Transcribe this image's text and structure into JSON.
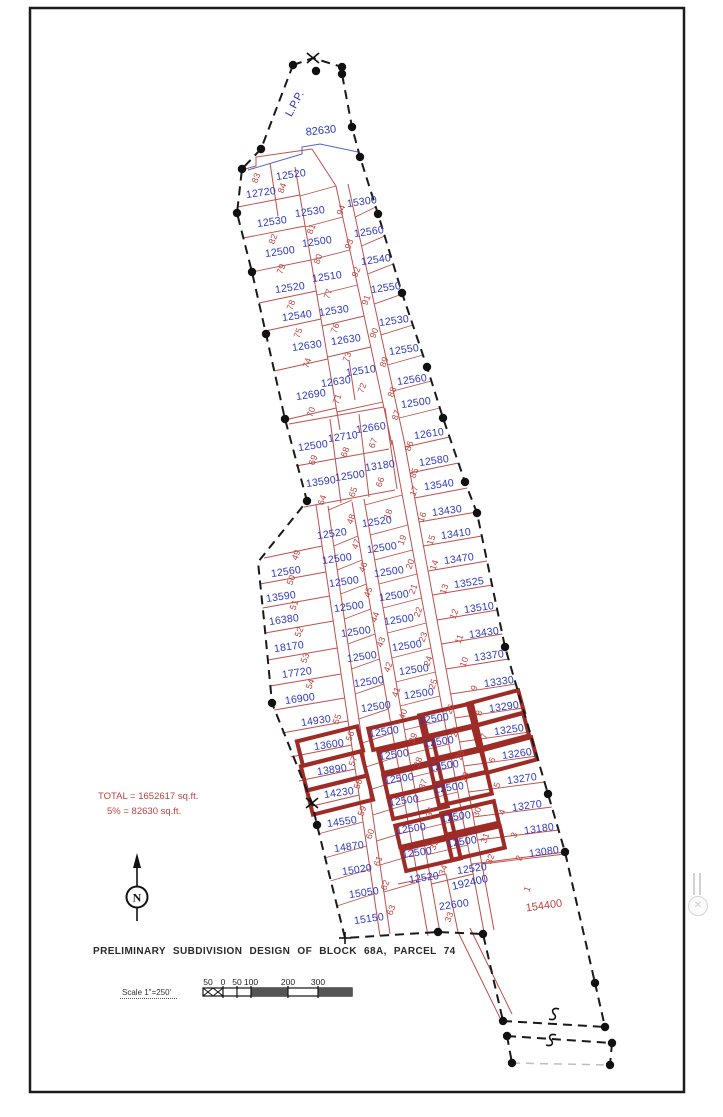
{
  "drawing": {
    "title": "PRELIMINARY SUBDIVISION DESIGN OF BLOCK 68A, PARCEL 74",
    "scale": {
      "label": "Scale 1\"=250'",
      "ticks": [
        "50",
        "0",
        "50",
        "100",
        "200",
        "300"
      ]
    },
    "summary": {
      "line1": "TOTAL  =  1652617  sq.ft.",
      "line2": "5%  =  82630  sq.ft."
    },
    "north_label": "N",
    "colors": {
      "area_text": "#2b36c4",
      "lot_text": "#bf4440",
      "lot_line": "#c0504d",
      "highlight": "#9e2b25",
      "boundary": "#1a1a1a"
    },
    "annotations": [
      {
        "t": "82630",
        "x": 321,
        "y": 131,
        "r": -6,
        "c": "blue ann"
      },
      {
        "t": "L.P.P.",
        "x": 295,
        "y": 104,
        "r": -62,
        "c": "blue ann"
      },
      {
        "t": "192400",
        "x": 470,
        "y": 883,
        "r": -13,
        "c": "blue ann"
      }
    ],
    "area_labels": [
      {
        "t": "12720",
        "x": 261,
        "y": 193
      },
      {
        "t": "12520",
        "x": 291,
        "y": 175
      },
      {
        "t": "12530",
        "x": 272,
        "y": 222
      },
      {
        "t": "12500",
        "x": 280,
        "y": 252
      },
      {
        "t": "12520",
        "x": 290,
        "y": 288
      },
      {
        "t": "12540",
        "x": 297,
        "y": 316
      },
      {
        "t": "12630",
        "x": 307,
        "y": 346
      },
      {
        "t": "12690",
        "x": 311,
        "y": 395
      },
      {
        "t": "12530",
        "x": 310,
        "y": 212
      },
      {
        "t": "12500",
        "x": 317,
        "y": 242
      },
      {
        "t": "12510",
        "x": 327,
        "y": 277
      },
      {
        "t": "12530",
        "x": 334,
        "y": 311
      },
      {
        "t": "12630",
        "x": 346,
        "y": 340
      },
      {
        "t": "12630",
        "x": 336,
        "y": 382
      },
      {
        "t": "12510",
        "x": 361,
        "y": 371
      },
      {
        "t": "15300",
        "x": 362,
        "y": 202
      },
      {
        "t": "12560",
        "x": 369,
        "y": 232
      },
      {
        "t": "12540",
        "x": 376,
        "y": 260
      },
      {
        "t": "12550",
        "x": 386,
        "y": 288
      },
      {
        "t": "12530",
        "x": 394,
        "y": 321
      },
      {
        "t": "12550",
        "x": 404,
        "y": 350
      },
      {
        "t": "12560",
        "x": 412,
        "y": 380
      },
      {
        "t": "12500",
        "x": 416,
        "y": 403
      },
      {
        "t": "12610",
        "x": 429,
        "y": 434
      },
      {
        "t": "12580",
        "x": 434,
        "y": 461
      },
      {
        "t": "12500",
        "x": 313,
        "y": 446
      },
      {
        "t": "12710",
        "x": 343,
        "y": 437
      },
      {
        "t": "12660",
        "x": 371,
        "y": 428
      },
      {
        "t": "13590",
        "x": 321,
        "y": 482
      },
      {
        "t": "12500",
        "x": 350,
        "y": 476
      },
      {
        "t": "13180",
        "x": 380,
        "y": 466
      },
      {
        "t": "13540",
        "x": 439,
        "y": 485
      },
      {
        "t": "13430",
        "x": 447,
        "y": 511
      },
      {
        "t": "13410",
        "x": 456,
        "y": 534
      },
      {
        "t": "13470",
        "x": 459,
        "y": 559
      },
      {
        "t": "13525",
        "x": 469,
        "y": 583
      },
      {
        "t": "13510",
        "x": 479,
        "y": 608
      },
      {
        "t": "13430",
        "x": 484,
        "y": 633
      },
      {
        "t": "13370",
        "x": 489,
        "y": 656
      },
      {
        "t": "13330",
        "x": 499,
        "y": 682
      },
      {
        "t": "13290",
        "x": 504,
        "y": 707
      },
      {
        "t": "13250",
        "x": 509,
        "y": 730
      },
      {
        "t": "13260",
        "x": 517,
        "y": 754
      },
      {
        "t": "13270",
        "x": 522,
        "y": 779
      },
      {
        "t": "13270",
        "x": 527,
        "y": 806
      },
      {
        "t": "13180",
        "x": 539,
        "y": 829
      },
      {
        "t": "13080",
        "x": 544,
        "y": 852
      },
      {
        "t": "154400",
        "x": 544,
        "y": 906,
        "c": "red-lg"
      },
      {
        "t": "12520",
        "x": 332,
        "y": 534
      },
      {
        "t": "12500",
        "x": 337,
        "y": 559
      },
      {
        "t": "12500",
        "x": 344,
        "y": 582
      },
      {
        "t": "12500",
        "x": 349,
        "y": 607
      },
      {
        "t": "12500",
        "x": 356,
        "y": 632
      },
      {
        "t": "12500",
        "x": 362,
        "y": 657
      },
      {
        "t": "12500",
        "x": 369,
        "y": 682
      },
      {
        "t": "12500",
        "x": 376,
        "y": 707
      },
      {
        "t": "12500",
        "x": 384,
        "y": 732
      },
      {
        "t": "12500",
        "x": 394,
        "y": 755
      },
      {
        "t": "12500",
        "x": 399,
        "y": 779
      },
      {
        "t": "12500",
        "x": 404,
        "y": 801
      },
      {
        "t": "12500",
        "x": 411,
        "y": 829
      },
      {
        "t": "12500",
        "x": 417,
        "y": 853
      },
      {
        "t": "12520",
        "x": 424,
        "y": 878
      },
      {
        "t": "12520",
        "x": 377,
        "y": 522
      },
      {
        "t": "12500",
        "x": 382,
        "y": 548
      },
      {
        "t": "12500",
        "x": 389,
        "y": 572
      },
      {
        "t": "12500",
        "x": 394,
        "y": 596
      },
      {
        "t": "12500",
        "x": 399,
        "y": 620
      },
      {
        "t": "12500",
        "x": 407,
        "y": 646
      },
      {
        "t": "12500",
        "x": 414,
        "y": 670
      },
      {
        "t": "12500",
        "x": 419,
        "y": 694
      },
      {
        "t": "12500",
        "x": 434,
        "y": 719
      },
      {
        "t": "12500",
        "x": 439,
        "y": 742
      },
      {
        "t": "12500",
        "x": 444,
        "y": 766
      },
      {
        "t": "12500",
        "x": 449,
        "y": 788
      },
      {
        "t": "12500",
        "x": 456,
        "y": 817
      },
      {
        "t": "12500",
        "x": 462,
        "y": 842
      },
      {
        "t": "12520",
        "x": 472,
        "y": 869
      },
      {
        "t": "12560",
        "x": 286,
        "y": 572
      },
      {
        "t": "13590",
        "x": 281,
        "y": 597
      },
      {
        "t": "16380",
        "x": 284,
        "y": 620
      },
      {
        "t": "18170",
        "x": 289,
        "y": 647
      },
      {
        "t": "17720",
        "x": 297,
        "y": 673
      },
      {
        "t": "16900",
        "x": 300,
        "y": 699
      },
      {
        "t": "14930",
        "x": 316,
        "y": 721
      },
      {
        "t": "13600",
        "x": 329,
        "y": 745
      },
      {
        "t": "13890",
        "x": 332,
        "y": 770
      },
      {
        "t": "14230",
        "x": 339,
        "y": 793
      },
      {
        "t": "14550",
        "x": 342,
        "y": 822
      },
      {
        "t": "14870",
        "x": 349,
        "y": 847
      },
      {
        "t": "15020",
        "x": 357,
        "y": 870
      },
      {
        "t": "15050",
        "x": 364,
        "y": 893
      },
      {
        "t": "15150",
        "x": 369,
        "y": 919
      },
      {
        "t": "22600",
        "x": 454,
        "y": 905
      }
    ],
    "lot_numbers": [
      {
        "t": "83",
        "x": 256,
        "y": 178
      },
      {
        "t": "84",
        "x": 282,
        "y": 188
      },
      {
        "t": "82",
        "x": 273,
        "y": 239
      },
      {
        "t": "79",
        "x": 281,
        "y": 269
      },
      {
        "t": "78",
        "x": 291,
        "y": 305
      },
      {
        "t": "75",
        "x": 298,
        "y": 333
      },
      {
        "t": "74",
        "x": 307,
        "y": 363
      },
      {
        "t": "70",
        "x": 311,
        "y": 412
      },
      {
        "t": "81",
        "x": 311,
        "y": 229
      },
      {
        "t": "80",
        "x": 318,
        "y": 259
      },
      {
        "t": "77",
        "x": 328,
        "y": 294
      },
      {
        "t": "76",
        "x": 335,
        "y": 328
      },
      {
        "t": "73",
        "x": 347,
        "y": 357
      },
      {
        "t": "71",
        "x": 337,
        "y": 399
      },
      {
        "t": "72",
        "x": 362,
        "y": 388
      },
      {
        "t": "94",
        "x": 341,
        "y": 210
      },
      {
        "t": "93",
        "x": 349,
        "y": 244
      },
      {
        "t": "92",
        "x": 356,
        "y": 272
      },
      {
        "t": "91",
        "x": 366,
        "y": 300
      },
      {
        "t": "90",
        "x": 374,
        "y": 333
      },
      {
        "t": "89",
        "x": 384,
        "y": 362
      },
      {
        "t": "88",
        "x": 392,
        "y": 392
      },
      {
        "t": "87",
        "x": 396,
        "y": 415
      },
      {
        "t": "86",
        "x": 409,
        "y": 446
      },
      {
        "t": "85",
        "x": 414,
        "y": 473
      },
      {
        "t": "69",
        "x": 313,
        "y": 460
      },
      {
        "t": "68",
        "x": 345,
        "y": 452
      },
      {
        "t": "67",
        "x": 373,
        "y": 443
      },
      {
        "t": "64",
        "x": 322,
        "y": 500
      },
      {
        "t": "65",
        "x": 353,
        "y": 492
      },
      {
        "t": "66",
        "x": 380,
        "y": 482
      },
      {
        "t": "17",
        "x": 414,
        "y": 491
      },
      {
        "t": "16",
        "x": 422,
        "y": 517
      },
      {
        "t": "15",
        "x": 431,
        "y": 540
      },
      {
        "t": "14",
        "x": 434,
        "y": 565
      },
      {
        "t": "13",
        "x": 444,
        "y": 589
      },
      {
        "t": "12",
        "x": 454,
        "y": 614
      },
      {
        "t": "11",
        "x": 459,
        "y": 639
      },
      {
        "t": "10",
        "x": 464,
        "y": 662
      },
      {
        "t": "9",
        "x": 474,
        "y": 688
      },
      {
        "t": "8",
        "x": 479,
        "y": 713
      },
      {
        "t": "7",
        "x": 484,
        "y": 736
      },
      {
        "t": "6",
        "x": 492,
        "y": 760
      },
      {
        "t": "5",
        "x": 497,
        "y": 785
      },
      {
        "t": "4",
        "x": 502,
        "y": 812
      },
      {
        "t": "3",
        "x": 514,
        "y": 835
      },
      {
        "t": "2",
        "x": 519,
        "y": 858
      },
      {
        "t": "1",
        "x": 527,
        "y": 889
      },
      {
        "t": "48",
        "x": 351,
        "y": 519
      },
      {
        "t": "47",
        "x": 356,
        "y": 544
      },
      {
        "t": "46",
        "x": 363,
        "y": 567
      },
      {
        "t": "45",
        "x": 368,
        "y": 592
      },
      {
        "t": "44",
        "x": 375,
        "y": 617
      },
      {
        "t": "43",
        "x": 381,
        "y": 642
      },
      {
        "t": "42",
        "x": 388,
        "y": 667
      },
      {
        "t": "41",
        "x": 396,
        "y": 692
      },
      {
        "t": "40",
        "x": 403,
        "y": 714
      },
      {
        "t": "39",
        "x": 413,
        "y": 738
      },
      {
        "t": "38",
        "x": 418,
        "y": 762
      },
      {
        "t": "37",
        "x": 423,
        "y": 784
      },
      {
        "t": "36",
        "x": 430,
        "y": 812
      },
      {
        "t": "35",
        "x": 434,
        "y": 845
      },
      {
        "t": "34",
        "x": 443,
        "y": 870
      },
      {
        "t": "18",
        "x": 388,
        "y": 514
      },
      {
        "t": "19",
        "x": 402,
        "y": 540
      },
      {
        "t": "20",
        "x": 410,
        "y": 564
      },
      {
        "t": "21",
        "x": 413,
        "y": 589
      },
      {
        "t": "22",
        "x": 418,
        "y": 612
      },
      {
        "t": "23",
        "x": 423,
        "y": 637
      },
      {
        "t": "24",
        "x": 428,
        "y": 661
      },
      {
        "t": "25",
        "x": 433,
        "y": 684
      },
      {
        "t": "26",
        "x": 450,
        "y": 709
      },
      {
        "t": "27",
        "x": 455,
        "y": 732
      },
      {
        "t": "28",
        "x": 460,
        "y": 755
      },
      {
        "t": "29",
        "x": 465,
        "y": 777
      },
      {
        "t": "30",
        "x": 477,
        "y": 812
      },
      {
        "t": "31",
        "x": 485,
        "y": 838
      },
      {
        "t": "32",
        "x": 490,
        "y": 859
      },
      {
        "t": "49",
        "x": 296,
        "y": 555
      },
      {
        "t": "50",
        "x": 291,
        "y": 580
      },
      {
        "t": "51",
        "x": 294,
        "y": 605
      },
      {
        "t": "52",
        "x": 299,
        "y": 632
      },
      {
        "t": "53",
        "x": 305,
        "y": 658
      },
      {
        "t": "54",
        "x": 310,
        "y": 684
      },
      {
        "t": "55",
        "x": 337,
        "y": 719
      },
      {
        "t": "56",
        "x": 350,
        "y": 736
      },
      {
        "t": "57",
        "x": 353,
        "y": 761
      },
      {
        "t": "58",
        "x": 358,
        "y": 784
      },
      {
        "t": "59",
        "x": 362,
        "y": 811
      },
      {
        "t": "60",
        "x": 370,
        "y": 834
      },
      {
        "t": "61",
        "x": 378,
        "y": 861
      },
      {
        "t": "62",
        "x": 385,
        "y": 885
      },
      {
        "t": "63",
        "x": 391,
        "y": 910
      },
      {
        "t": "33",
        "x": 449,
        "y": 917
      }
    ],
    "highlighted_lots": [
      {
        "lot": "56",
        "x": 330,
        "y": 746,
        "w": 62,
        "h": 25,
        "r": -14
      },
      {
        "lot": "57",
        "x": 334,
        "y": 771,
        "w": 62,
        "h": 25,
        "r": -14
      },
      {
        "lot": "58",
        "x": 340,
        "y": 795,
        "w": 62,
        "h": 25,
        "r": -14
      },
      {
        "lot": "40",
        "x": 398,
        "y": 733,
        "w": 56,
        "h": 22,
        "r": -13
      },
      {
        "lot": "39",
        "x": 408,
        "y": 756,
        "w": 56,
        "h": 22,
        "r": -13
      },
      {
        "lot": "38",
        "x": 413,
        "y": 780,
        "w": 56,
        "h": 22,
        "r": -13
      },
      {
        "lot": "37",
        "x": 418,
        "y": 802,
        "w": 56,
        "h": 22,
        "r": -13
      },
      {
        "lot": "36",
        "x": 425,
        "y": 830,
        "w": 56,
        "h": 22,
        "r": -13
      },
      {
        "lot": "35",
        "x": 431,
        "y": 854,
        "w": 56,
        "h": 22,
        "r": -13
      },
      {
        "lot": "26",
        "x": 448,
        "y": 720,
        "w": 54,
        "h": 22,
        "r": -13
      },
      {
        "lot": "27",
        "x": 453,
        "y": 743,
        "w": 54,
        "h": 22,
        "r": -13
      },
      {
        "lot": "28",
        "x": 458,
        "y": 767,
        "w": 54,
        "h": 22,
        "r": -13
      },
      {
        "lot": "29",
        "x": 463,
        "y": 789,
        "w": 54,
        "h": 22,
        "r": -13
      },
      {
        "lot": "30",
        "x": 470,
        "y": 818,
        "w": 54,
        "h": 22,
        "r": -13
      },
      {
        "lot": "31",
        "x": 476,
        "y": 843,
        "w": 54,
        "h": 22,
        "r": -13
      },
      {
        "lot": "8",
        "x": 496,
        "y": 708,
        "w": 52,
        "h": 23,
        "r": -15
      },
      {
        "lot": "7",
        "x": 501,
        "y": 731,
        "w": 52,
        "h": 23,
        "r": -15
      },
      {
        "lot": "6",
        "x": 509,
        "y": 755,
        "w": 52,
        "h": 23,
        "r": -15
      }
    ],
    "scale_tick_x": [
      208,
      223,
      237,
      251,
      288,
      318
    ]
  }
}
